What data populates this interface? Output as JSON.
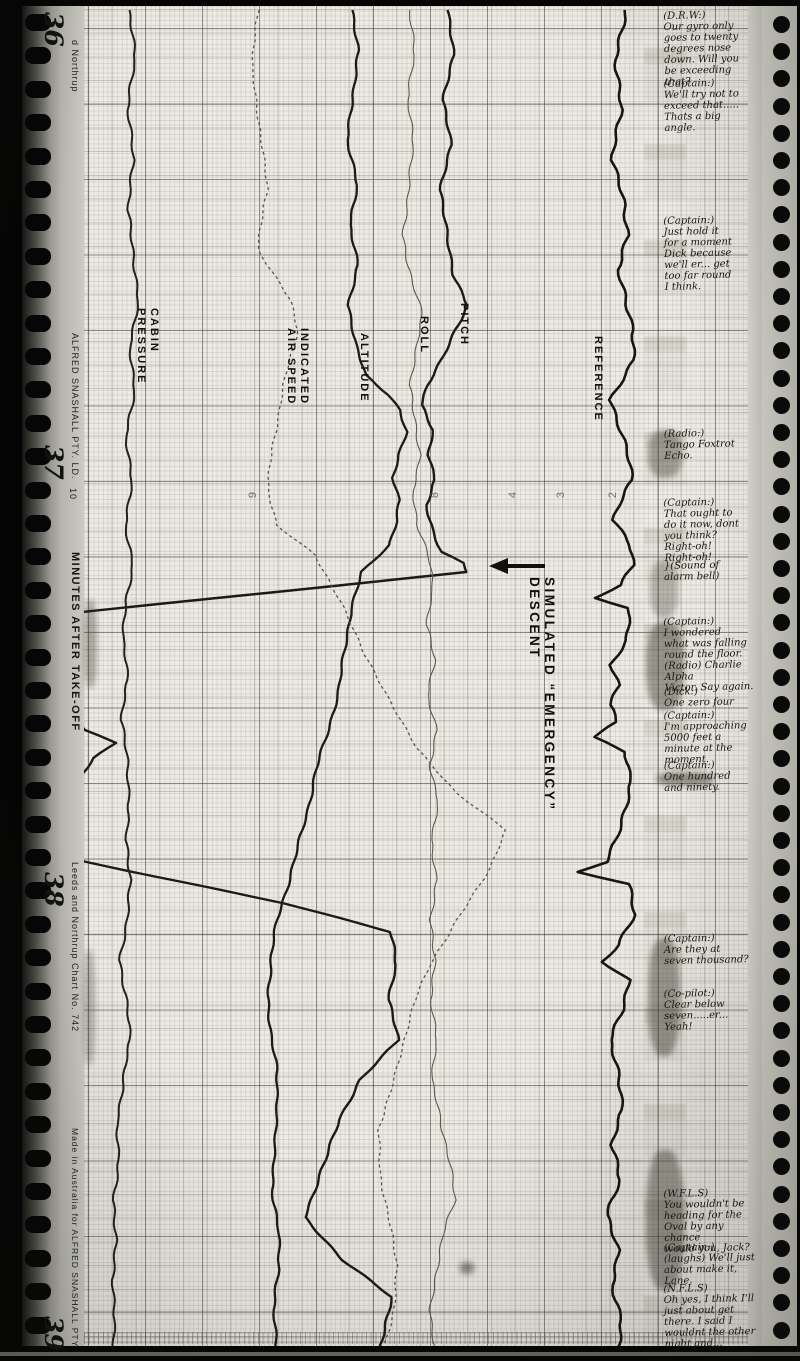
{
  "film": {
    "frames": [
      {
        "label": "36",
        "y": 12
      },
      {
        "label": "37",
        "y": 445
      },
      {
        "label": "38",
        "y": 872
      },
      {
        "label": "39",
        "y": 1316
      }
    ]
  },
  "margin_left": {
    "brand_top": "d Northrup",
    "maker": "ALFRED SNASHALL PTY. LD.",
    "scale_digit": "10",
    "axis_label": "MINUTES AFTER TAKE-OFF",
    "chart_no": "Leeds and Northrup  Chart  No. 742",
    "made_in": "Made in Australia for ALFRED SNASHALL PTY"
  },
  "chart_data": {
    "type": "line",
    "orientation": "vertical-strip-chart",
    "title": "SIMULATED “EMERGENCY” DESCENT",
    "xlabel": "MINUTES AFTER TAKE-OFF",
    "grid": "on",
    "paper_color": "#eceae3",
    "ink_color": "#1a1a16",
    "scale_ticks": [
      {
        "t": "9",
        "x": 250
      },
      {
        "t": "8",
        "x": 432
      },
      {
        "t": "4",
        "x": 510
      },
      {
        "t": "3",
        "x": 558
      },
      {
        "t": "2",
        "x": 610
      }
    ],
    "scale_row_y": 489,
    "series": [
      {
        "name": "REFERENCE",
        "label": "REFERENCE",
        "label_x": 604,
        "label_y": 336,
        "color": "#151512",
        "width": 2.6,
        "jitter": 2.6,
        "dash": null,
        "points": [
          [
            10,
            624
          ],
          [
            60,
            616
          ],
          [
            110,
            621
          ],
          [
            160,
            614
          ],
          [
            200,
            624
          ],
          [
            235,
            630
          ],
          [
            270,
            618
          ],
          [
            300,
            626
          ],
          [
            330,
            634
          ],
          [
            360,
            632
          ],
          [
            385,
            618
          ],
          [
            400,
            610
          ],
          [
            425,
            618
          ],
          [
            455,
            626
          ],
          [
            480,
            631
          ],
          [
            500,
            621
          ],
          [
            520,
            613
          ],
          [
            545,
            629
          ],
          [
            565,
            633
          ],
          [
            585,
            622
          ],
          [
            598,
            596
          ],
          [
            608,
            630
          ],
          [
            640,
            627
          ],
          [
            665,
            613
          ],
          [
            685,
            621
          ],
          [
            705,
            611
          ],
          [
            722,
            617
          ],
          [
            737,
            594
          ],
          [
            752,
            627
          ],
          [
            782,
            632
          ],
          [
            810,
            624
          ],
          [
            840,
            616
          ],
          [
            862,
            606
          ],
          [
            872,
            578
          ],
          [
            884,
            627
          ],
          [
            915,
            633
          ],
          [
            945,
            618
          ],
          [
            962,
            602
          ],
          [
            980,
            627
          ],
          [
            1010,
            622
          ],
          [
            1040,
            611
          ],
          [
            1075,
            618
          ],
          [
            1110,
            624
          ],
          [
            1145,
            613
          ],
          [
            1180,
            621
          ],
          [
            1215,
            609
          ],
          [
            1250,
            618
          ],
          [
            1285,
            613
          ],
          [
            1320,
            621
          ],
          [
            1350,
            616
          ]
        ]
      },
      {
        "name": "PITCH",
        "label": "PITCH",
        "label_x": 470,
        "label_y": 303,
        "color": "#1a1a16",
        "width": 2.4,
        "jitter": 1.8,
        "dash": null,
        "points": [
          [
            10,
            448
          ],
          [
            55,
            452
          ],
          [
            100,
            443
          ],
          [
            145,
            450
          ],
          [
            190,
            441
          ],
          [
            235,
            447
          ],
          [
            275,
            455
          ],
          [
            305,
            468
          ],
          [
            330,
            456
          ],
          [
            360,
            443
          ],
          [
            385,
            428
          ],
          [
            405,
            421
          ],
          [
            430,
            433
          ],
          [
            455,
            429
          ],
          [
            480,
            434
          ],
          [
            505,
            425
          ],
          [
            530,
            432
          ],
          [
            552,
            441
          ],
          [
            563,
            462
          ],
          [
            572,
            466
          ],
          [
            612,
            82
          ],
          [
            640,
            70
          ],
          [
            668,
            64
          ],
          [
            700,
            68
          ],
          [
            730,
            86
          ],
          [
            743,
            116
          ],
          [
            758,
            94
          ],
          [
            790,
            71
          ],
          [
            825,
            65
          ],
          [
            857,
            62
          ],
          [
            903,
            284
          ],
          [
            932,
            390
          ],
          [
            965,
            396
          ],
          [
            1000,
            388
          ],
          [
            1040,
            397
          ],
          [
            1080,
            360
          ],
          [
            1120,
            338
          ],
          [
            1160,
            326
          ],
          [
            1217,
            305
          ],
          [
            1260,
            344
          ],
          [
            1297,
            392
          ],
          [
            1330,
            386
          ],
          [
            1350,
            380
          ]
        ]
      },
      {
        "name": "ALTITUDE",
        "label": "ALTITUDE",
        "label_x": 370,
        "label_y": 333,
        "color": "#1a1a16",
        "width": 2.3,
        "jitter": 1.6,
        "dash": null,
        "points": [
          [
            10,
            352
          ],
          [
            50,
            359
          ],
          [
            95,
            352
          ],
          [
            140,
            347
          ],
          [
            185,
            356
          ],
          [
            225,
            350
          ],
          [
            265,
            357
          ],
          [
            305,
            349
          ],
          [
            345,
            356
          ],
          [
            375,
            366
          ],
          [
            395,
            390
          ],
          [
            410,
            401
          ],
          [
            432,
            407
          ],
          [
            455,
            399
          ],
          [
            478,
            394
          ],
          [
            500,
            400
          ],
          [
            522,
            396
          ],
          [
            545,
            389
          ],
          [
            572,
            362
          ],
          [
            610,
            350
          ],
          [
            650,
            344
          ],
          [
            690,
            338
          ],
          [
            730,
            328
          ],
          [
            770,
            316
          ],
          [
            810,
            308
          ],
          [
            850,
            298
          ],
          [
            890,
            287
          ],
          [
            920,
            278
          ],
          [
            955,
            272
          ],
          [
            995,
            268
          ],
          [
            1035,
            271
          ],
          [
            1070,
            276
          ],
          [
            1110,
            277
          ],
          [
            1150,
            273
          ],
          [
            1190,
            272
          ],
          [
            1230,
            278
          ],
          [
            1270,
            279
          ],
          [
            1310,
            274
          ],
          [
            1350,
            277
          ]
        ]
      },
      {
        "name": "CABIN PRESSURE",
        "label": "CABIN\nPRESSURE",
        "label_x": 160,
        "label_y": 308,
        "color": "#22221d",
        "width": 2.0,
        "jitter": 1.8,
        "dash": null,
        "points": [
          [
            10,
            130
          ],
          [
            60,
            136
          ],
          [
            110,
            128
          ],
          [
            160,
            134
          ],
          [
            210,
            127
          ],
          [
            255,
            133
          ],
          [
            300,
            137
          ],
          [
            345,
            130
          ],
          [
            390,
            134
          ],
          [
            435,
            127
          ],
          [
            480,
            132
          ],
          [
            525,
            127
          ],
          [
            565,
            133
          ],
          [
            600,
            127
          ],
          [
            640,
            123
          ],
          [
            680,
            127
          ],
          [
            720,
            121
          ],
          [
            760,
            126
          ],
          [
            800,
            129
          ],
          [
            840,
            125
          ],
          [
            880,
            131
          ],
          [
            920,
            127
          ],
          [
            960,
            121
          ],
          [
            1000,
            127
          ],
          [
            1040,
            131
          ],
          [
            1080,
            124
          ],
          [
            1120,
            117
          ],
          [
            1160,
            119
          ],
          [
            1200,
            112
          ],
          [
            1240,
            116
          ],
          [
            1280,
            111
          ],
          [
            1320,
            115
          ],
          [
            1350,
            113
          ]
        ]
      },
      {
        "name": "INDICATED AIR SPEED",
        "label": "INDICATED\nAIR SPEED",
        "label_x": 310,
        "label_y": 328,
        "color": "#56544b",
        "width": 1.3,
        "jitter": 1.5,
        "dash": "3 3",
        "points": [
          [
            10,
            258
          ],
          [
            70,
            252
          ],
          [
            130,
            261
          ],
          [
            190,
            268
          ],
          [
            250,
            257
          ],
          [
            300,
            291
          ],
          [
            330,
            297
          ],
          [
            370,
            286
          ],
          [
            410,
            279
          ],
          [
            450,
            271
          ],
          [
            490,
            268
          ],
          [
            525,
            276
          ],
          [
            555,
            316
          ],
          [
            600,
            340
          ],
          [
            650,
            364
          ],
          [
            700,
            389
          ],
          [
            750,
            419
          ],
          [
            792,
            454
          ],
          [
            830,
            506
          ],
          [
            868,
            489
          ],
          [
            900,
            469
          ],
          [
            935,
            448
          ],
          [
            965,
            429
          ],
          [
            995,
            417
          ],
          [
            1025,
            409
          ],
          [
            1060,
            399
          ],
          [
            1095,
            391
          ],
          [
            1130,
            379
          ],
          [
            1175,
            381
          ],
          [
            1220,
            389
          ],
          [
            1265,
            397
          ],
          [
            1305,
            394
          ],
          [
            1350,
            383
          ]
        ]
      },
      {
        "name": "ROLL",
        "label": "ROLL",
        "label_x": 430,
        "label_y": 316,
        "color": "#5b594f",
        "width": 1.1,
        "jitter": 1.8,
        "dash": null,
        "points": [
          [
            10,
            408
          ],
          [
            55,
            414
          ],
          [
            100,
            407
          ],
          [
            145,
            414
          ],
          [
            190,
            409
          ],
          [
            235,
            404
          ],
          [
            280,
            412
          ],
          [
            315,
            423
          ],
          [
            350,
            417
          ],
          [
            385,
            409
          ],
          [
            420,
            415
          ],
          [
            455,
            419
          ],
          [
            490,
            412
          ],
          [
            525,
            417
          ],
          [
            558,
            428
          ],
          [
            590,
            433
          ],
          [
            625,
            427
          ],
          [
            660,
            435
          ],
          [
            695,
            429
          ],
          [
            730,
            437
          ],
          [
            765,
            431
          ],
          [
            800,
            439
          ],
          [
            840,
            431
          ],
          [
            880,
            437
          ],
          [
            920,
            429
          ],
          [
            960,
            435
          ],
          [
            1000,
            429
          ],
          [
            1040,
            437
          ],
          [
            1080,
            431
          ],
          [
            1120,
            441
          ],
          [
            1160,
            450
          ],
          [
            1200,
            456
          ],
          [
            1235,
            444
          ],
          [
            1270,
            437
          ],
          [
            1310,
            431
          ],
          [
            1350,
            434
          ]
        ]
      }
    ]
  },
  "annotations": [
    {
      "y": 10,
      "text": "(D.R.W:)\nOur gyro only\ngoes to twenty\ndegrees nose\ndown. Will you\nbe exceeding that?"
    },
    {
      "y": 78,
      "text": "(Captain:)\nWe'll try not to\nexceed that.....\nThats a big\nangle."
    },
    {
      "y": 215,
      "text": "(Captain:)\nJust hold it\nfor a moment\nDick because\nwe'll er... get\ntoo far round\nI think."
    },
    {
      "y": 428,
      "text": "(Radio:)\nTango Foxtrot\nEcho."
    },
    {
      "y": 497,
      "text": "(Captain:)\nThat ought to\ndo it now, dont\nyou think?\nRight-oh!\nRight-oh!"
    },
    {
      "y": 560,
      "text": "}(Sound of\nalarm bell)"
    },
    {
      "y": 616,
      "text": "(Captain:)\nI wondered\nwhat was falling\nround the floor.\n(Radio) Charlie Alpha\nVictor. Say again."
    },
    {
      "y": 686,
      "text": "(Dick:)\nOne zero four"
    },
    {
      "y": 710,
      "text": "(Captain:)\nI'm approaching\n5000 feet a\nminute at the\nmoment."
    },
    {
      "y": 760,
      "text": "(Captain:)\nOne hundred\nand ninety."
    },
    {
      "y": 933,
      "text": "(Captain:)\nAre they at\nseven thousand?"
    },
    {
      "y": 988,
      "text": "(Co-pilot:)\nClear below\nseven.....er...\nYeah!"
    },
    {
      "y": 1188,
      "text": "(W.F.L.S)\nYou wouldn't be\nheading for the\nOval by any chance\nwould you, Jack?"
    },
    {
      "y": 1242,
      "text": "(Captain:)\n(laughs) We'll just\nabout make it,\nLane."
    },
    {
      "y": 1283,
      "text": "(N.F.L.S)\nOh yes, I think I'll\njust about get\nthere. I said I\nwouldnt the other\nnight and..."
    }
  ]
}
